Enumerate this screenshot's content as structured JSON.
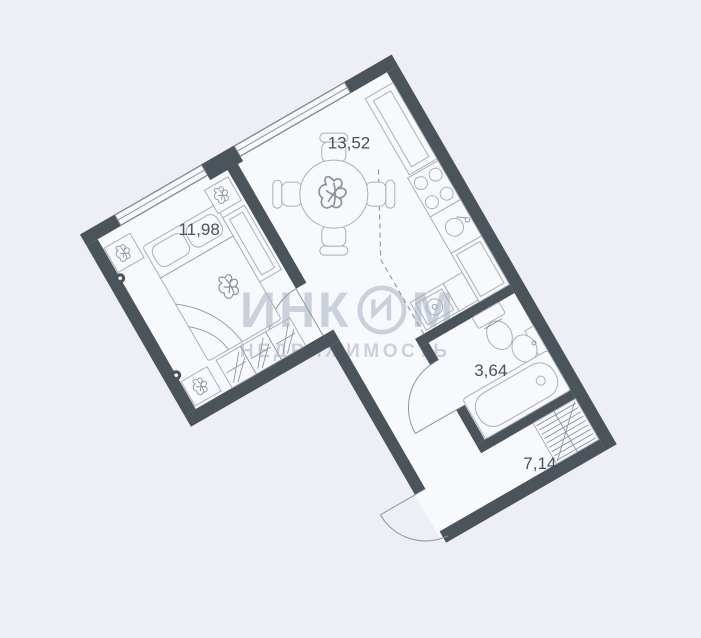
{
  "watermark": {
    "brand_prefix": "ИНК",
    "brand_suffix": "М",
    "subtitle": "НЕДВИЖИМОСТЬ",
    "color": "#aeb5c4"
  },
  "floorplan": {
    "rotation_deg": -30,
    "colors": {
      "background": "#edeff4",
      "floor": "#f8f9fc",
      "wall": "#4b535b",
      "furniture": "#a9b0b9",
      "furniture2": "#8d959f",
      "window-line": "#8d959f",
      "label": "#4a525c",
      "wm": "#aeb5c4"
    },
    "rooms": [
      {
        "id": "bedroom",
        "area_label": "11,98",
        "fixtures": [
          "double-bed",
          "pillows",
          "nightstand",
          "plant",
          "wall-lamp",
          "hatched-dresser",
          "wardrobe"
        ]
      },
      {
        "id": "kitchen-living",
        "area_label": "13,52",
        "fixtures": [
          "round-dining-table",
          "four-chairs",
          "tall-cabinet",
          "stove-4-burners",
          "kitchen-sink",
          "counter",
          "washing-machine",
          "dashed-zone-line"
        ]
      },
      {
        "id": "bathroom",
        "area_label": "3,64",
        "fixtures": [
          "toilet",
          "washbasin",
          "bathtub"
        ]
      },
      {
        "id": "hallway",
        "area_label": "7,14",
        "fixtures": [
          "built-in-wardrobe",
          "entrance-door-arc"
        ]
      }
    ]
  }
}
